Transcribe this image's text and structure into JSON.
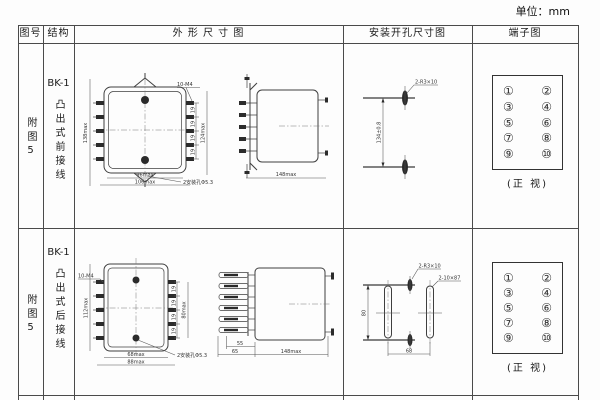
{
  "unit_label": "单位：mm",
  "headers": {
    "fig_no": "图号",
    "structure": "结构",
    "outline": "外 形 尺 寸 图",
    "install": "安装开孔尺寸图",
    "terminal": "端子图"
  },
  "rows": [
    {
      "fig_no": "附图5",
      "model": "BK-1",
      "structure": "凸出式前接线",
      "outline": {
        "thread": "10-M4",
        "height": "138max",
        "pitch": "19",
        "right_height": "124max",
        "width_inner": "96max",
        "width_outer": "106max",
        "hole_note": "2安装孔Φ5.3",
        "depth": "148max"
      },
      "install": {
        "slot": "2-R3×10",
        "spacing": "134±0.8"
      },
      "terminal": {
        "cells": [
          "①",
          "②",
          "③",
          "④",
          "⑤",
          "⑥",
          "⑦",
          "⑧",
          "⑨",
          "⑩"
        ],
        "caption": "(正 视)"
      }
    },
    {
      "fig_no": "附图5",
      "model": "BK-1",
      "structure": "凸出式后接线",
      "outline": {
        "thread": "10-M4",
        "height": "112max",
        "pitch": "19",
        "right_height": "80max",
        "width_inner": "68max",
        "width_outer": "88max",
        "hole_note": "2安装孔Φ5.3",
        "depth_inner1": "55",
        "depth_inner2": "65",
        "depth": "148max"
      },
      "install": {
        "slot_small": "2-R3×10",
        "slot_long": "2-10×87",
        "spacing_v": "80",
        "spacing_h": "68"
      },
      "terminal": {
        "cells": [
          "①",
          "②",
          "③",
          "④",
          "⑤",
          "⑥",
          "⑦",
          "⑧",
          "⑨",
          "⑩"
        ],
        "caption": "(正 视)"
      }
    }
  ]
}
